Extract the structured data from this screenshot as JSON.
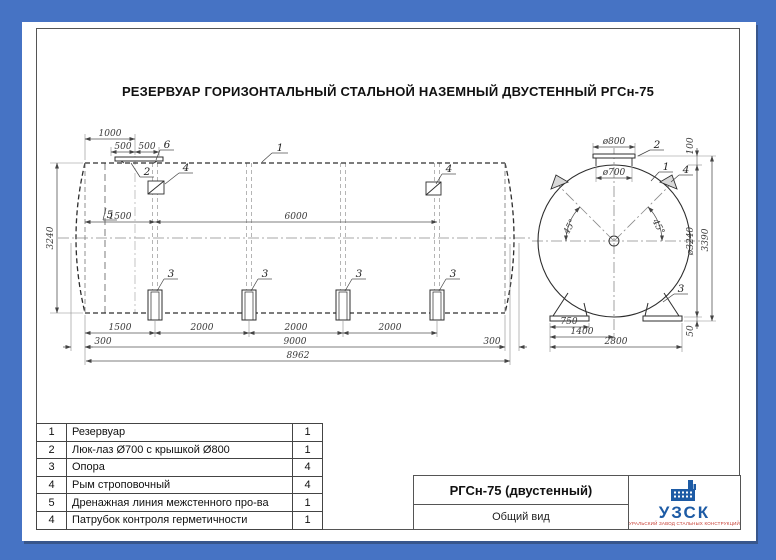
{
  "title": "РЕЗЕРВУАР ГОРИЗОНТАЛЬНЫЙ СТАЛЬНОЙ НАЗЕМНЫЙ ДВУСТЕННЫЙ РГСн-75",
  "colors": {
    "canvas_blue": "#4673c4",
    "drawing_line": "#2d2d2d",
    "logo_blue": "#1d5ba5",
    "logo_red": "#c4372d"
  },
  "side_view": {
    "dims": {
      "d1000": "1000",
      "d500a": "500",
      "d500b": "500",
      "d1500t": "1500",
      "d6000": "6000",
      "d3240": "3240",
      "d1500b": "1500",
      "d2000a": "2000",
      "d2000b": "2000",
      "d2000c": "2000",
      "d300l": "300",
      "d9000": "9000",
      "d300r": "300",
      "d8962": "8962"
    },
    "callouts": {
      "n1": "1",
      "n2": "2",
      "n3": "3",
      "n4": "4",
      "n5": "5",
      "n6": "6"
    }
  },
  "end_view": {
    "dims": {
      "d800": "ø800",
      "d700": "ø700",
      "a45l": "45°",
      "a45r": "45°",
      "d100": "100",
      "d3240": "ø3240",
      "d3390": "3390",
      "d50": "50",
      "d750": "750",
      "d1400": "1400",
      "d2800": "2800"
    },
    "callouts": {
      "n1": "1",
      "n2": "2",
      "n3": "3",
      "n4": "4"
    }
  },
  "parts_table": {
    "rows": [
      {
        "pos": "1",
        "name": "Резервуар",
        "qty": "1"
      },
      {
        "pos": "2",
        "name": "Люк-лаз Ø700 с крышкой Ø800",
        "qty": "1"
      },
      {
        "pos": "3",
        "name": "Опора",
        "qty": "4"
      },
      {
        "pos": "4",
        "name": "Рым строповочный",
        "qty": "4"
      },
      {
        "pos": "5",
        "name": "Дренажная линия межстенного про-ва",
        "qty": "1"
      },
      {
        "pos": "4",
        "name": "Патрубок контроля герметичности",
        "qty": "1"
      }
    ]
  },
  "title_block": {
    "model": "РГСн-75 (двустенный)",
    "view": "Общий вид",
    "brand": "УЗСК",
    "tagline": "УРАЛЬСКИЙ ЗАВОД СТАЛЬНЫХ КОНСТРУКЦИЙ"
  }
}
